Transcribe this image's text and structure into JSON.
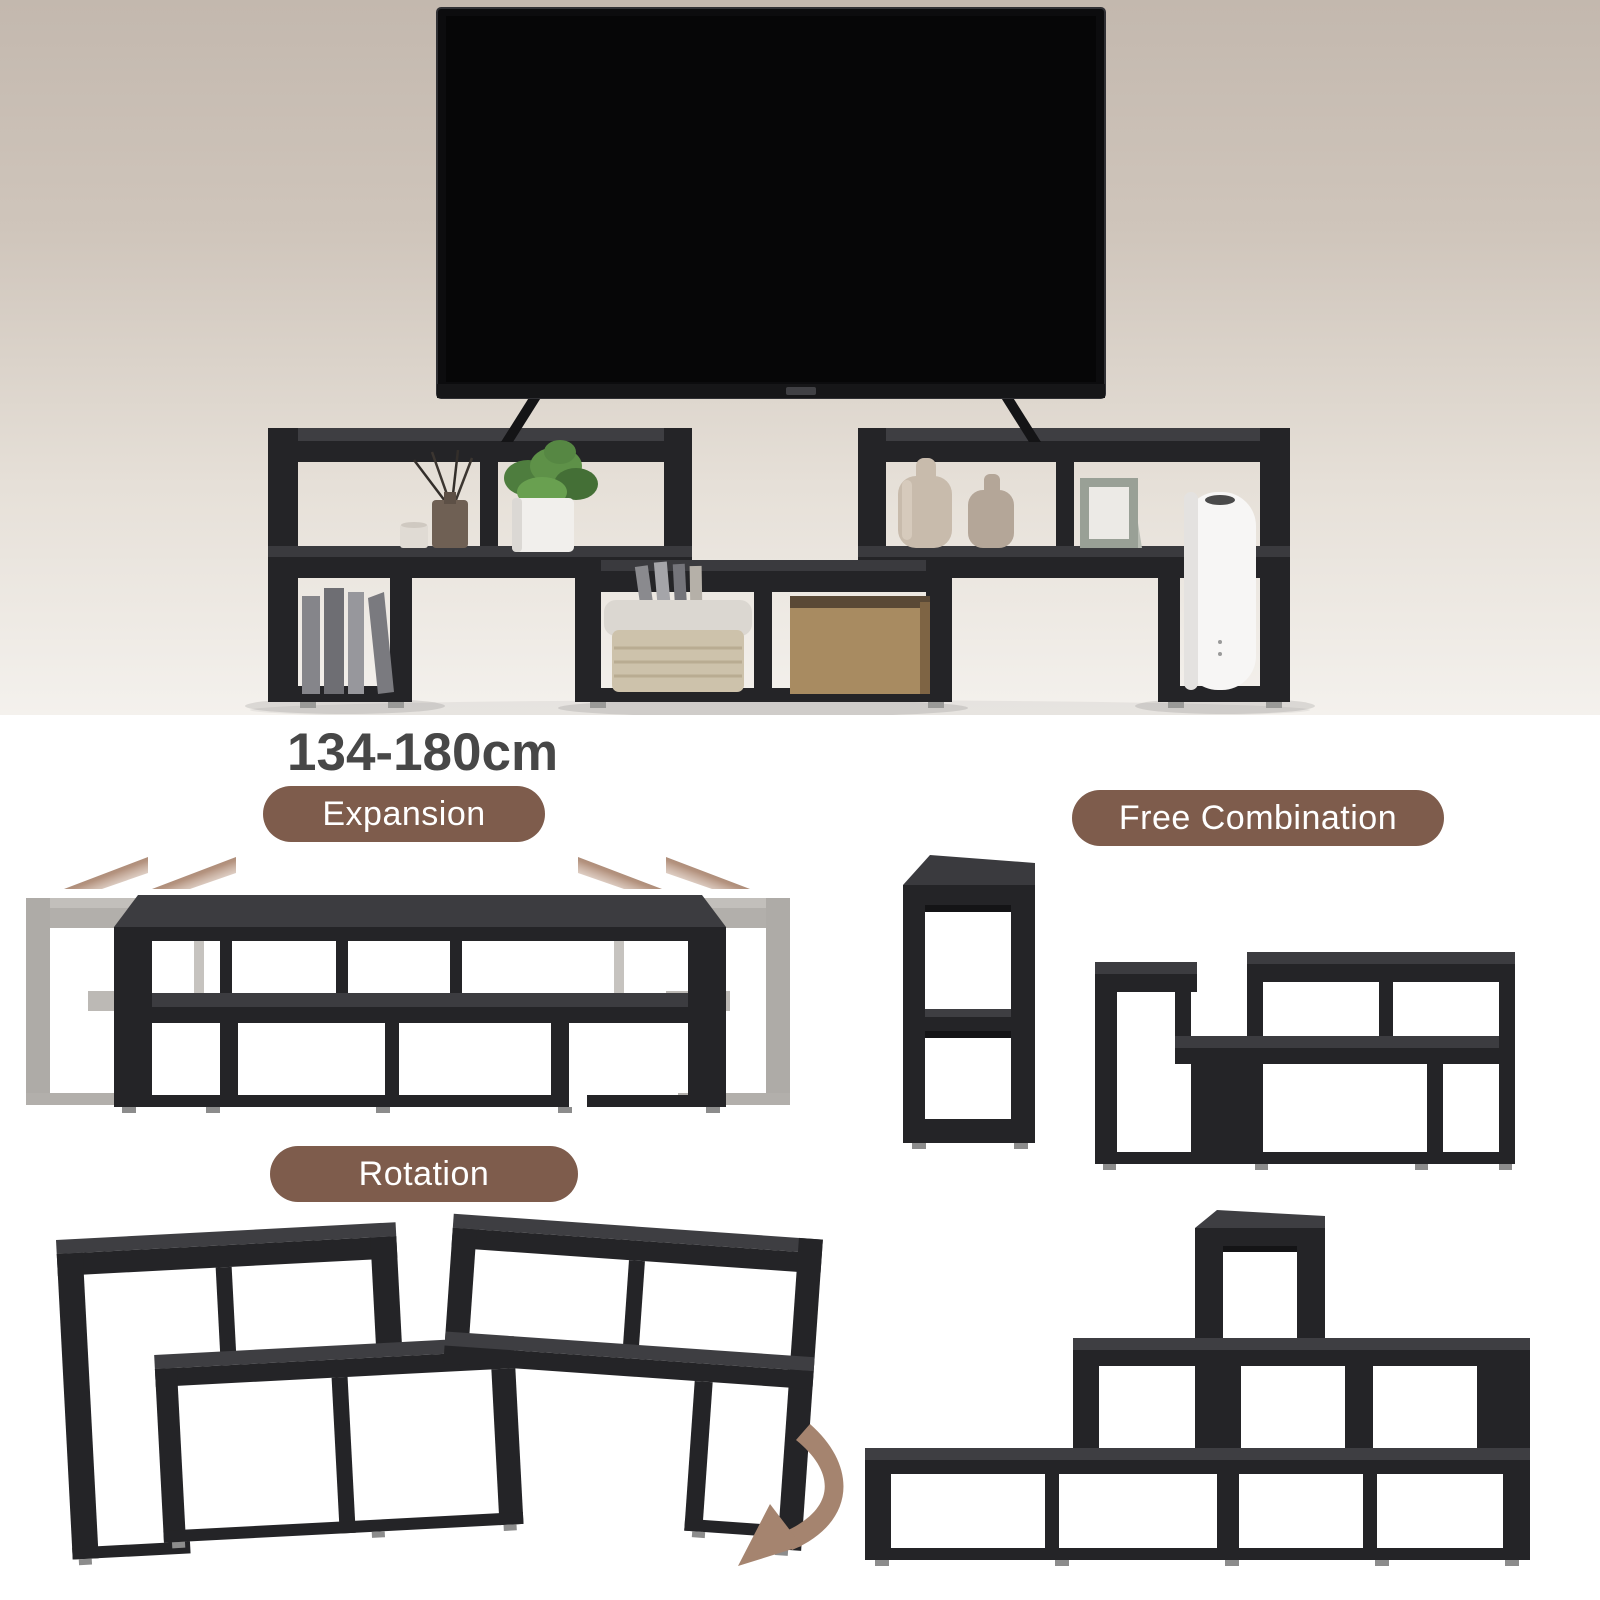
{
  "size_label": "134-180cm",
  "badges": {
    "expansion": "Expansion",
    "free_combination": "Free Combination",
    "rotation": "Rotation"
  },
  "colors": {
    "hero_bg_top": "#c3b8ae",
    "hero_bg_bottom": "#f4f1ed",
    "panel_bg": "#ffffff",
    "badge_brown": "#7e5c4c",
    "badge_text": "#ffffff",
    "heading_gray": "#474747",
    "shelf_black_front": "#242427",
    "shelf_black_top": "#3e3e42",
    "ghost_gray": "#aeaba7",
    "arrow_brown": "#8a6752",
    "tv_black": "#0c0c0e"
  },
  "hero_items": [
    "flat-screen-tv",
    "modular-shelf-tv-stand",
    "books",
    "reed-diffuser",
    "candle-jar",
    "potted-plant",
    "tall-vase",
    "small-vase",
    "photo-frame",
    "air-purifier",
    "storage-basket",
    "magazines",
    "wooden-box"
  ],
  "diagram_icons": [
    "expansion-arrows",
    "rotation-curved-arrow"
  ]
}
